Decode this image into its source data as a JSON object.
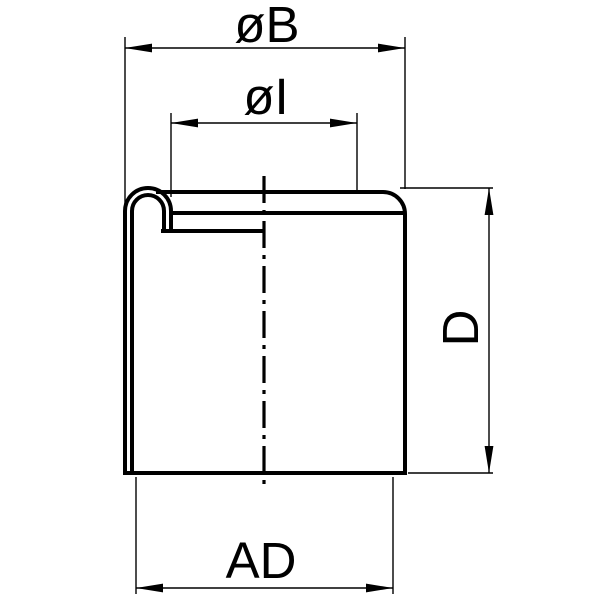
{
  "drawing": {
    "kind": "technical-dimension-drawing",
    "part": "tube-end-cap-half-section",
    "dimensions": {
      "outer_diameter": {
        "label": "øB",
        "orientation": "horizontal",
        "position": "top"
      },
      "inner_diameter": {
        "label": "øI",
        "orientation": "horizontal",
        "position": "top-inner"
      },
      "height": {
        "label": "D",
        "orientation": "vertical",
        "position": "right"
      },
      "fit_diameter": {
        "label": "AD",
        "orientation": "horizontal",
        "position": "bottom"
      }
    },
    "colors": {
      "line": "#000000",
      "background": "#ffffff"
    }
  }
}
